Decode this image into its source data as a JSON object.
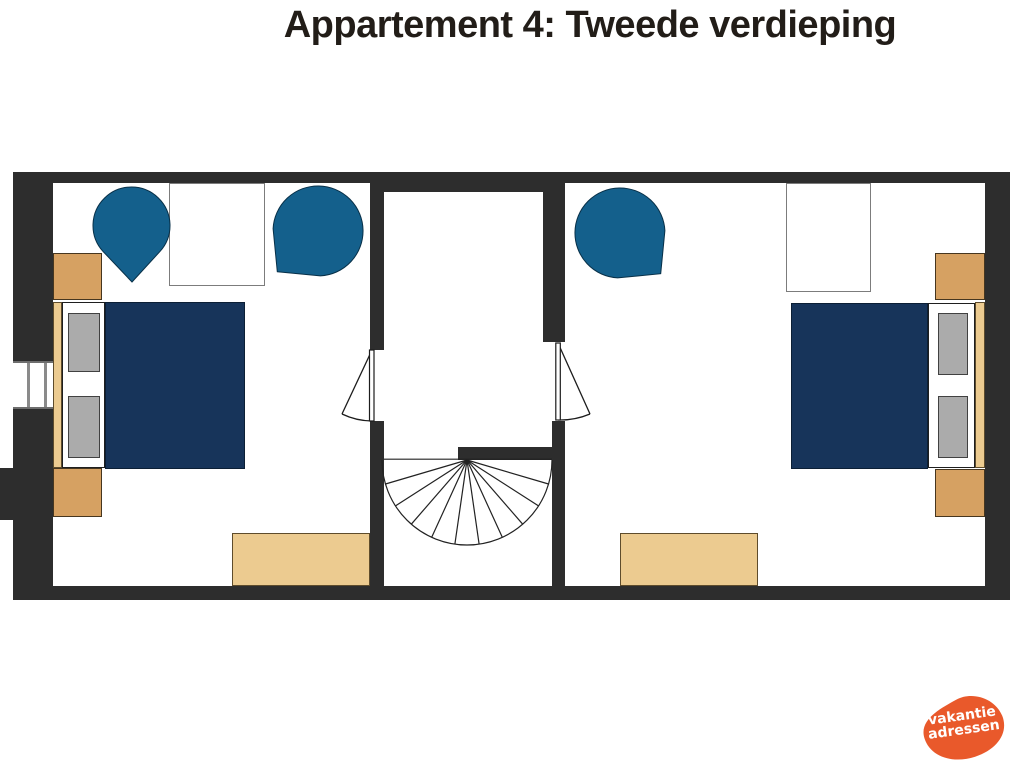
{
  "title": "Appartement 4: Tweede verdieping",
  "logo": {
    "line1": "vakantie",
    "line2": "adressen"
  },
  "colors": {
    "ink": "#221d18",
    "wall": "#2d2d2d",
    "chair": "#14608c",
    "blanket": "#17345a",
    "wood": "#d6a162",
    "wood-light": "#eccb90",
    "pillow": "#ababab",
    "line": "#1c1c1c",
    "logo": "#e9592b"
  }
}
